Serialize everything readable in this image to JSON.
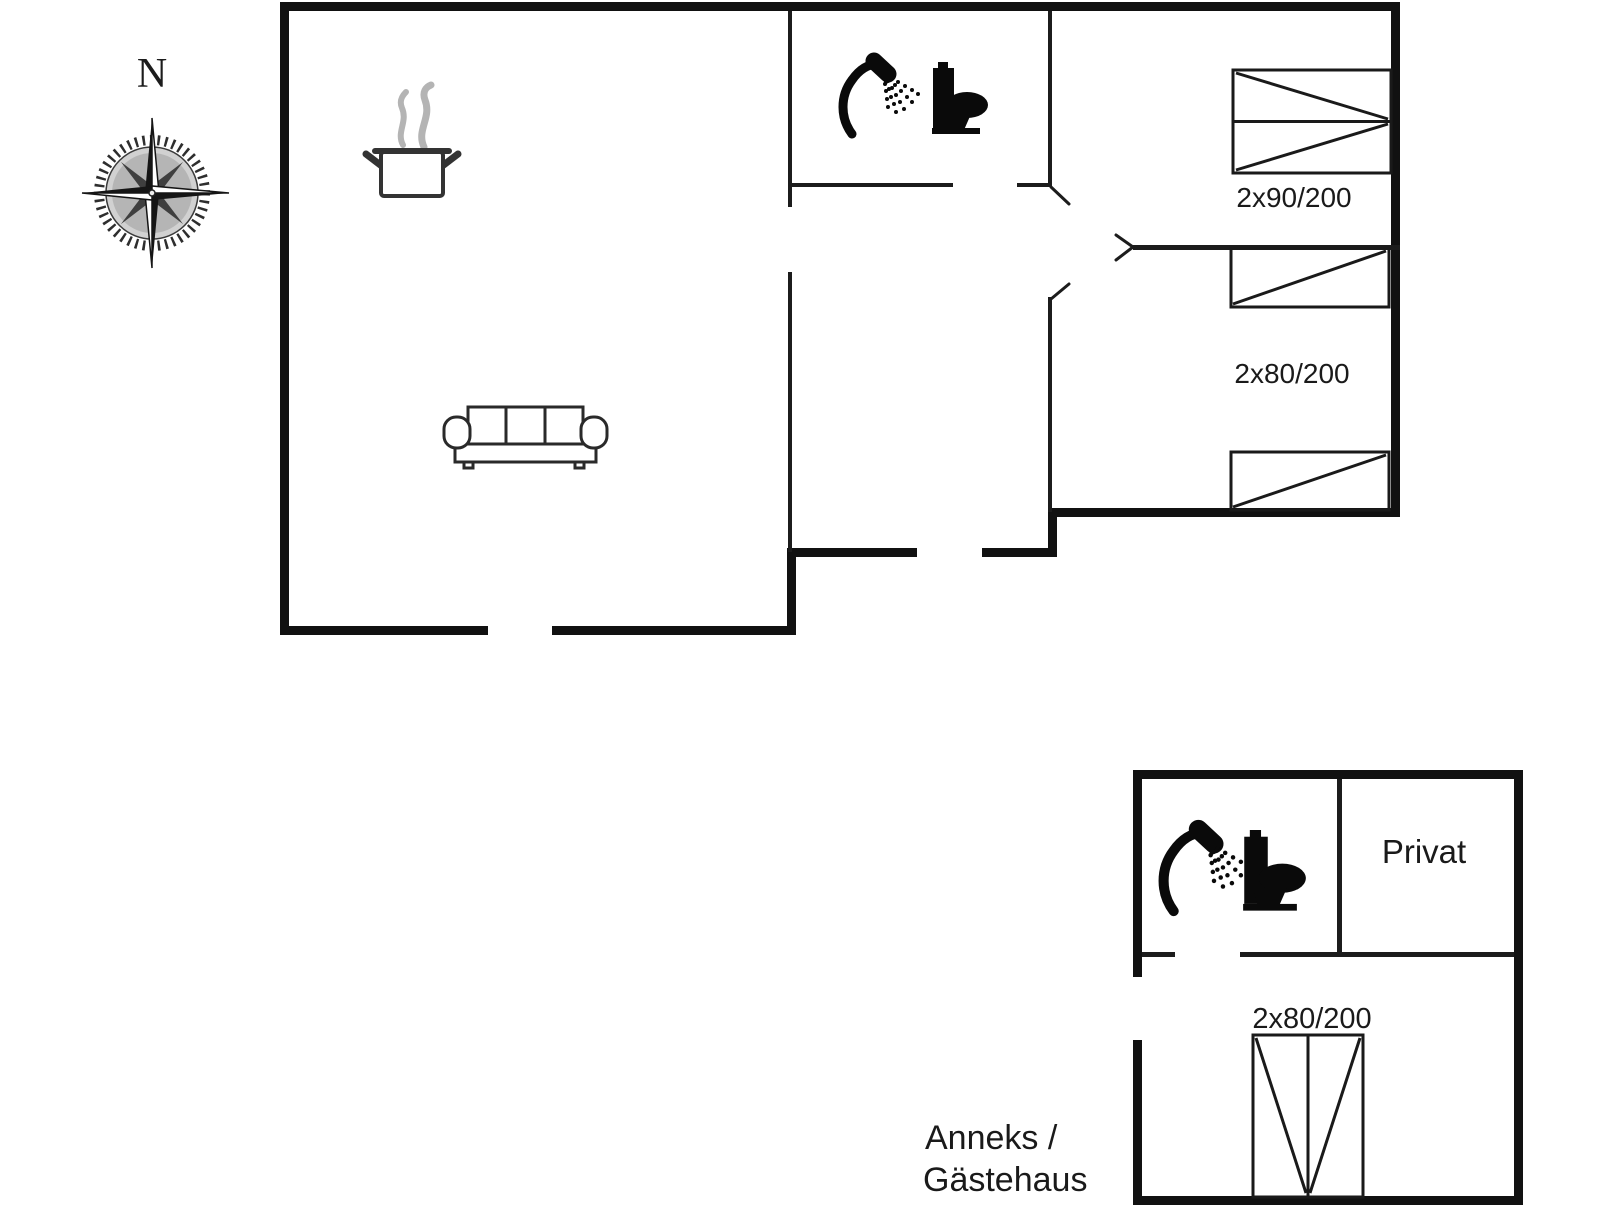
{
  "page": {
    "background": "#ffffff",
    "kind": "holiday-home floor plan, main house and annex"
  },
  "colors": {
    "outer_wall": "#111111",
    "interior_wall": "#1c1c1c",
    "furniture_line": "#1a1a1a",
    "icon_black": "#0a0a0a",
    "steam_gray": "#b4b4b4",
    "text": "#1a1a1a"
  },
  "compass": {
    "north_label": "N"
  },
  "main_house": {
    "bedroom_top": {
      "bed_label": "2x90/200"
    },
    "bedroom_right": {
      "bed_label": "2x80/200"
    },
    "icons": {
      "stove": "cooking-pot-icon",
      "sofa": "sofa-icon",
      "shower": "shower-icon",
      "toilet": "toilet-icon"
    }
  },
  "annex": {
    "title_line1": "Anneks /",
    "title_line2": "Gästehaus",
    "private_room_label": "Privat",
    "bedroom": {
      "bed_label": "2x80/200"
    },
    "icons": {
      "shower": "shower-icon",
      "toilet": "toilet-icon"
    }
  }
}
